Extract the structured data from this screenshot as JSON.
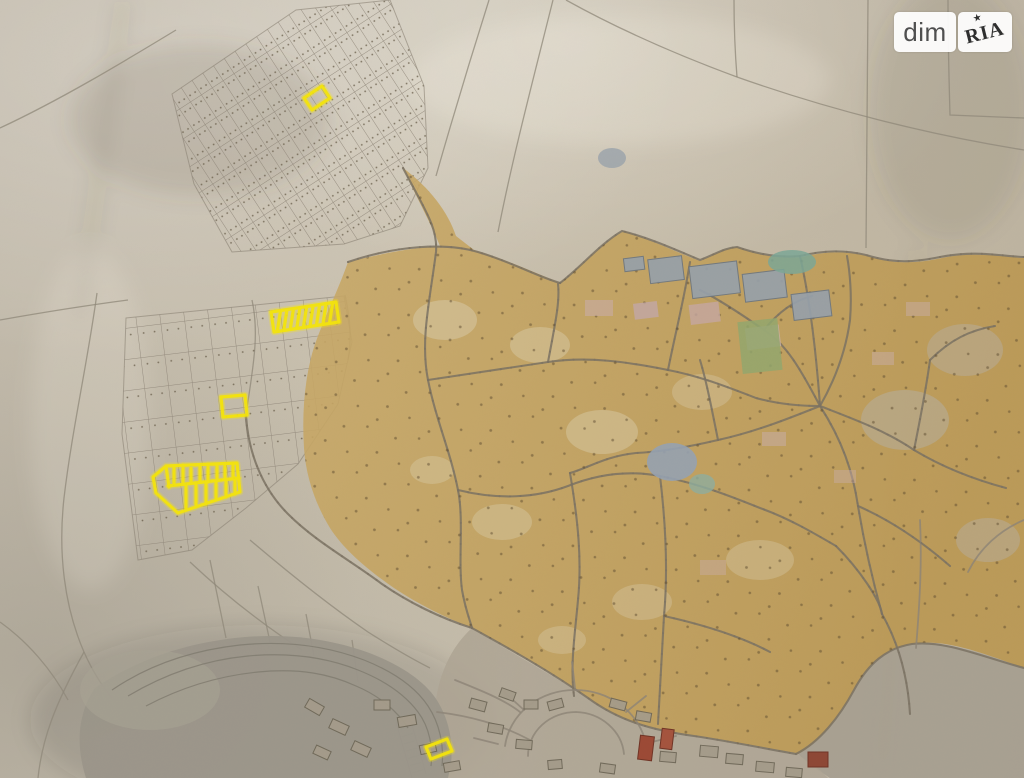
{
  "watermark": {
    "brand_left": "dim",
    "brand_right": "RIA",
    "star_icon": "★"
  },
  "map": {
    "kind": "scanned-paper-cadastral-plan-photo",
    "highlight_color": "#f2e30d",
    "highlights": [
      {
        "id": "plot-northwest-small",
        "shape": "rotated-rect",
        "path": "M304,98 L322,86 L330,98 L312,110 Z"
      },
      {
        "id": "plot-strip-of-ten",
        "shape": "subdivided-strip",
        "path": "M271,312 L336,302 L339,322 L274,332 Z M280.5,311.2 L277.3,331 M286.9,310.2 L283.8,330 M293.4,309.2 L290.3,328.9 M299.9,308.1 L296.8,327.9 M306.6,307.1 L303.4,326.9 M313.1,306.1 L310,325.9 M319.6,305.1 L316.5,324.8 M326.1,304 L323,323.8 M332.7,303 L329.5,322.8"
      },
      {
        "id": "plot-center-small",
        "shape": "rotated-rect",
        "path": "M221,397 L245,395 L247,415 L223,417 Z"
      },
      {
        "id": "plot-block-subdivided",
        "shape": "subdivided-polygon",
        "path": "M153,477 L166,466 L237,463 L240,492 L178,513 L156,493 Z M166,466 L169,487 M168,486 L239,478 M174,466 L174,485 M183,465 L183,484 M191,465 L191,483 M200,465 L200,482 M208,464 L208,482 M217,464 L217,481 M225,464 L225,480 M233,463 L233,479 M186,484 L186,510 M196,483 L196,507 M206,482 L206,504 M216,481 L216,500 M226,479 L226,497 M235,478 L235,494"
      },
      {
        "id": "plot-south-small",
        "shape": "rotated-rect",
        "path": "M426,747 L447,739 L452,751 L431,759 Z"
      }
    ]
  }
}
